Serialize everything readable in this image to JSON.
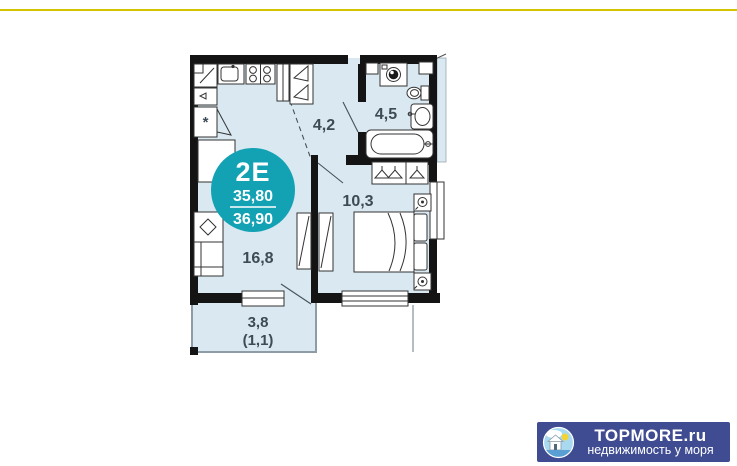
{
  "floorplan": {
    "badge": {
      "unit_type": "2E",
      "area_main": "35,80",
      "area_total": "36,90",
      "color": "#12a2b4"
    },
    "labels": {
      "hallway": "4,2",
      "bathroom": "4,5",
      "bedroom": "10,3",
      "living": "16,8",
      "balcony": "3,8",
      "balcony_reduced": "(1,1)",
      "fridge_mark": "*"
    },
    "colors": {
      "floor_fill": "#d9e8f1",
      "wall": "#141414",
      "balcony_outline": "#8d9ca6",
      "top_line": "#d4c400"
    }
  },
  "watermark": {
    "brand": "TOPMORE.ru",
    "tagline": "недвижимость у моря",
    "background": "#3f4c92",
    "logo": "house-by-sea-icon"
  }
}
